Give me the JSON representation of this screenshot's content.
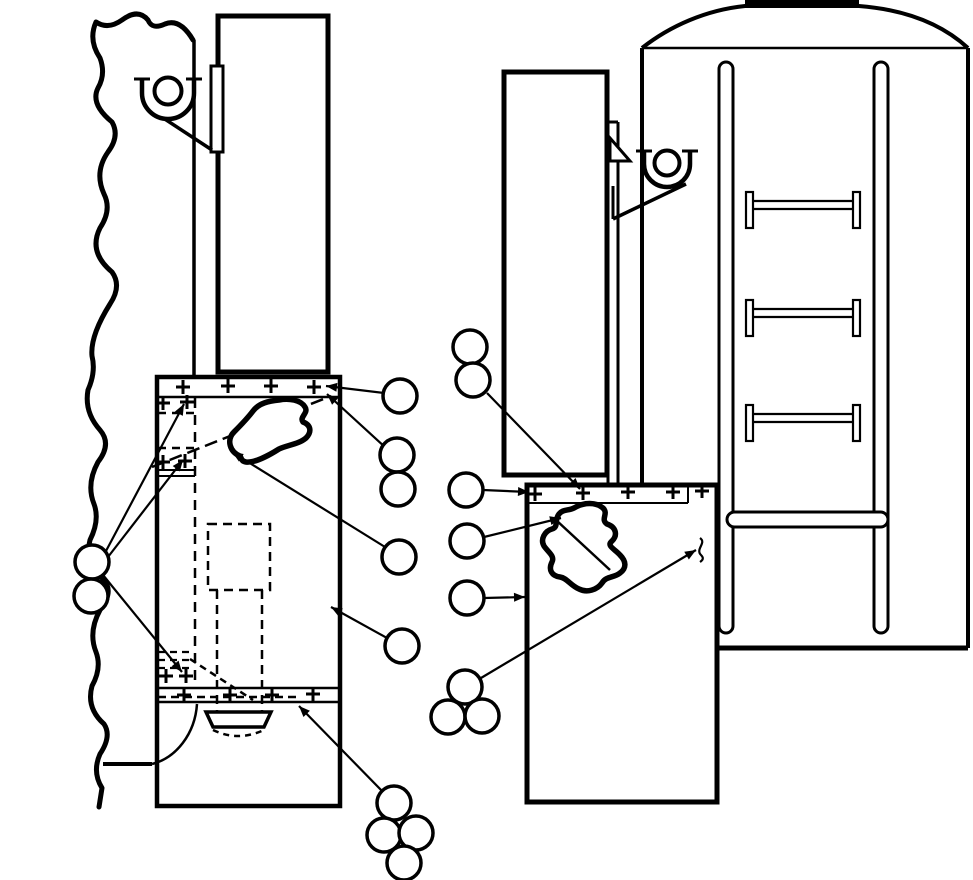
{
  "figure": {
    "type": "technical-line-illustration-panel-repair",
    "paper": "#ffffff",
    "ink": "#000000"
  },
  "plus_marks": {
    "arm": 7,
    "stroke": 3,
    "groups": [
      {
        "name": "left-top-rail-rivets",
        "points": [
          [
            183,
            387
          ],
          [
            228,
            386
          ],
          [
            271,
            386
          ],
          [
            314,
            387
          ]
        ]
      },
      {
        "name": "left-hinge-strip-rivets",
        "points": [
          [
            163,
            403
          ],
          [
            187,
            402
          ],
          [
            163,
            462
          ],
          [
            185,
            461
          ],
          [
            166,
            676
          ],
          [
            186,
            676
          ]
        ]
      },
      {
        "name": "left-bottom-rail-rivets",
        "points": [
          [
            184,
            695
          ],
          [
            230,
            695
          ],
          [
            272,
            695
          ],
          [
            313,
            694
          ]
        ]
      },
      {
        "name": "right-skin-rail-rivets",
        "points": [
          [
            535,
            494
          ],
          [
            583,
            493
          ],
          [
            628,
            492
          ],
          [
            673,
            492
          ],
          [
            702,
            491
          ]
        ]
      }
    ]
  },
  "callouts": {
    "radius": 17,
    "stroke": 3.5,
    "circles": [
      {
        "id": "c1",
        "cx": 400,
        "cy": 396
      },
      {
        "id": "c2",
        "cx": 397,
        "cy": 455
      },
      {
        "id": "c3",
        "cx": 398,
        "cy": 489
      },
      {
        "id": "c4",
        "cx": 399,
        "cy": 557
      },
      {
        "id": "c5",
        "cx": 402,
        "cy": 646
      },
      {
        "id": "c6",
        "cx": 92,
        "cy": 562
      },
      {
        "id": "c7",
        "cx": 91,
        "cy": 596
      },
      {
        "id": "c8",
        "cx": 470,
        "cy": 347
      },
      {
        "id": "c9",
        "cx": 473,
        "cy": 380
      },
      {
        "id": "c10",
        "cx": 466,
        "cy": 490
      },
      {
        "id": "c11",
        "cx": 467,
        "cy": 541
      },
      {
        "id": "c12",
        "cx": 467,
        "cy": 598
      },
      {
        "id": "c13",
        "cx": 465,
        "cy": 687
      },
      {
        "id": "c14",
        "cx": 448,
        "cy": 717
      },
      {
        "id": "c15",
        "cx": 482,
        "cy": 716
      },
      {
        "id": "c16",
        "cx": 394,
        "cy": 803
      },
      {
        "id": "c17",
        "cx": 384,
        "cy": 835
      },
      {
        "id": "c18",
        "cx": 416,
        "cy": 833
      },
      {
        "id": "c19",
        "cx": 404,
        "cy": 863
      }
    ],
    "leaders": [
      {
        "from": [
          384,
          393
        ],
        "to": [
          326,
          386
        ],
        "arrow": true
      },
      {
        "from": [
          386,
          448
        ],
        "to": [
          327,
          394
        ],
        "arrow": true
      },
      {
        "from": [
          385,
          547
        ],
        "to": [
          232,
          452
        ],
        "arrow": true
      },
      {
        "from": [
          387,
          638
        ],
        "to": [
          331,
          607
        ],
        "arrow": true
      },
      {
        "from": [
          106,
          551
        ],
        "to": [
          184,
          404
        ],
        "arrow": true
      },
      {
        "from": [
          108,
          557
        ],
        "to": [
          183,
          460
        ],
        "arrow": true
      },
      {
        "from": [
          103,
          575
        ],
        "to": [
          182,
          672
        ],
        "arrow": true
      },
      {
        "from": [
          487,
          393
        ],
        "to": [
          580,
          489
        ],
        "arrow": true
      },
      {
        "from": [
          483,
          490
        ],
        "to": [
          529,
          492
        ],
        "arrow": true
      },
      {
        "from": [
          484,
          537
        ],
        "to": [
          561,
          518
        ],
        "arrow": true
      },
      {
        "from": [
          484,
          598
        ],
        "to": [
          525,
          597
        ],
        "arrow": true
      },
      {
        "from": [
          481,
          678
        ],
        "to": [
          696,
          550
        ],
        "arrow": true
      },
      {
        "from": [
          382,
          791
        ],
        "to": [
          299,
          706
        ],
        "arrow": true
      }
    ]
  },
  "ladder": {
    "rail_x": [
      719,
      874
    ],
    "rail_width": 14,
    "rail_top": 62,
    "rail_bottom": 633,
    "rung_tops": [
      192,
      300,
      405
    ],
    "rung_height": 36,
    "rung_x1": 746,
    "rung_x2": 860,
    "cap_width": 7,
    "web_offsets": [
      9,
      17
    ],
    "bar": {
      "x": 727,
      "y": 512,
      "width": 161,
      "height": 15
    }
  }
}
